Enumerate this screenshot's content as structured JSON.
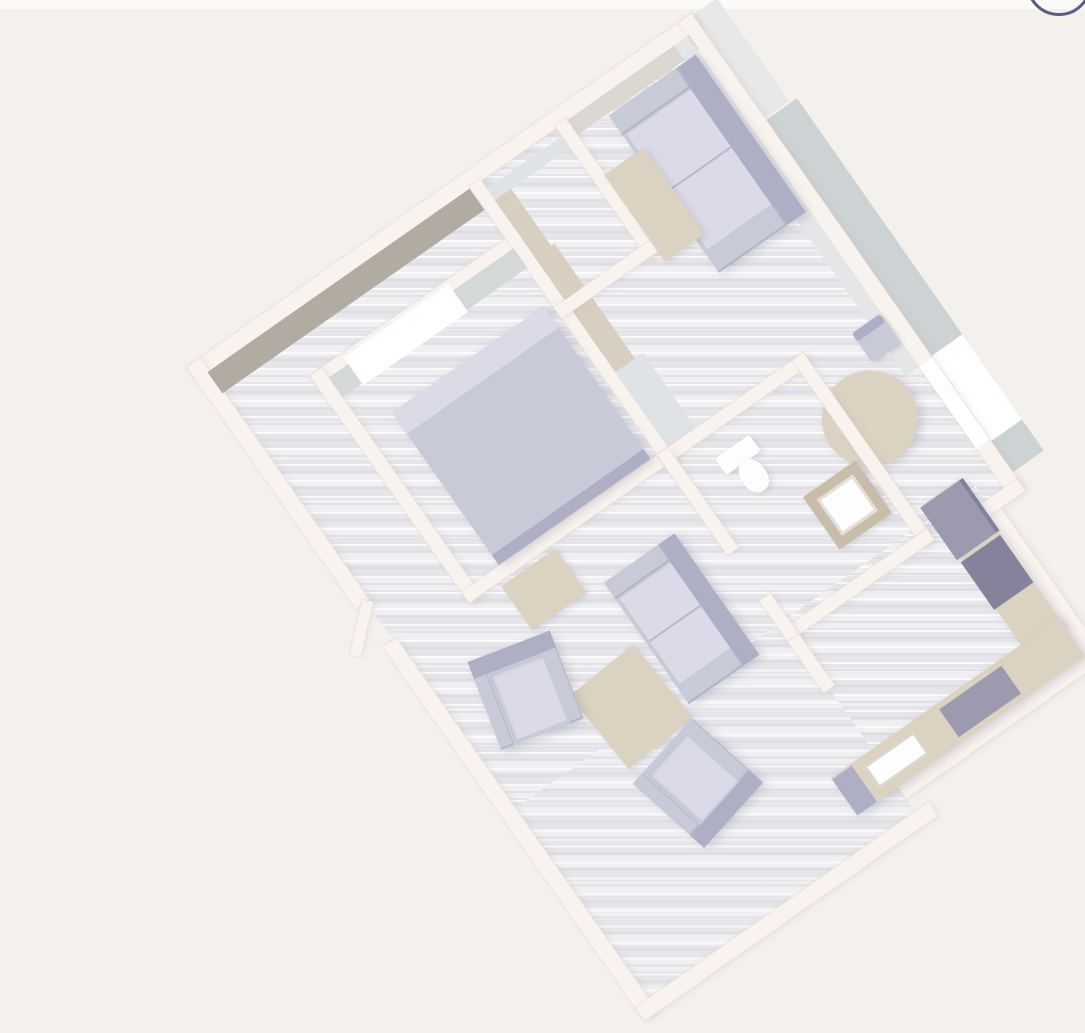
{
  "view": {
    "type": "3d-floor-plan-render",
    "rotation_deg": -35,
    "description": "Overhead 3D dollhouse view of a one-bedroom apartment, rotated diagonally on a plain warm-gray canvas"
  },
  "colors": {
    "bg": "#f4f1ed",
    "top_strip": "#fbfaf9",
    "wall": "#f9f3ef",
    "wallface_taupe": "#b2aba2",
    "wallface_warm": "#dcd7d1",
    "wallface_gray": "#e4e6e7",
    "wallface_green": "#d4d9d7",
    "wallface_blue": "#dfe3e5",
    "wardrobe_beige": "#d9cfc0",
    "floor_base": "#e9e9ec",
    "balcony_floor": "#cdd2d4",
    "balcony_outer": "#e7e8e7",
    "lavender": "#c9cad8",
    "lavender_dark": "#aeafc4",
    "lavender_light": "#dadbe6",
    "beige": "#dcd2c1",
    "beige_dark": "#c9bda9",
    "appliance": "#9b9aaf",
    "appliance_dark": "#84839b",
    "fixture_white": "#fdfdfd",
    "window_white": "#ffffff",
    "accent": "#5a5a8c"
  },
  "ui": {
    "corner_control": {
      "shape": "circle-arc",
      "position": "top-right",
      "color": "#5a5a8c"
    }
  },
  "scene": {
    "rooms": [
      {
        "name": "bedroom",
        "furniture": [
          "double-bed",
          "wardrobe",
          "window-bench",
          "side-table"
        ]
      },
      {
        "name": "closet",
        "furniture": [
          "built-in-shelving"
        ]
      },
      {
        "name": "living-room-upper",
        "furniture": [
          "sofa",
          "coffee-table",
          "round-dining-table",
          "dining-chair",
          "dining-chair"
        ]
      },
      {
        "name": "bathroom",
        "furniture": [
          "toilet",
          "vanity-sink"
        ]
      },
      {
        "name": "kitchen",
        "furniture": [
          "fridge",
          "oven",
          "cooktop",
          "kitchen-sink",
          "l-shaped-counter",
          "end-cabinet"
        ]
      },
      {
        "name": "living-room-lower",
        "furniture": [
          "loveseat",
          "coffee-table",
          "armchair",
          "armchair",
          "console-table"
        ]
      },
      {
        "name": "balcony",
        "furniture": [
          "glass-window"
        ]
      }
    ],
    "entrance": "angled-door-west-wall"
  }
}
